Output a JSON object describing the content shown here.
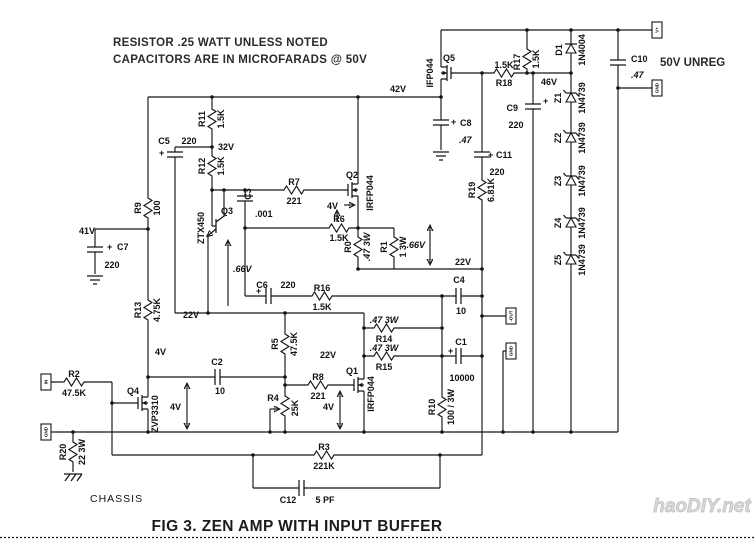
{
  "labels": {
    "note1": "RESISTOR  .25 WATT UNLESS NOTED",
    "note2": "CAPACITORS ARE IN MICROFARADS @ 50V",
    "caption": "FIG 3.  ZEN AMP WITH INPUT BUFFER",
    "watermark": "haoDIY.net",
    "supply": "50V UNREG",
    "chassis": "CHASSIS"
  },
  "terminals": {
    "input": "IN",
    "input_gnd": "GND",
    "output": "-OUT",
    "output_gnd": "GND",
    "supply_pos": "V+",
    "supply_gnd": "GND"
  },
  "symbols": {
    "plus": "+"
  },
  "voltages": {
    "v41": "41V",
    "v42": "42V",
    "v32": "32V",
    "v46": "46V",
    "v22_left": "22V",
    "v22_mid": "22V",
    "v22_out": "22V",
    "v4_q2": "4V",
    "v4_q4": "4V",
    "v4_q1": "4V",
    "v4_src": "4V",
    "vbe_q3": ".66V",
    "v_r1": ".66V"
  },
  "components": {
    "r0": {
      "ref": "R0",
      "value": ".47 3W"
    },
    "r1": {
      "ref": "R1",
      "value": "1 3W"
    },
    "r2": {
      "ref": "R2",
      "value": "47.5K"
    },
    "r3": {
      "ref": "R3",
      "value": "221K"
    },
    "r4": {
      "ref": "R4",
      "value": "25K"
    },
    "r5": {
      "ref": "R5",
      "value": "47.5K"
    },
    "r6": {
      "ref": "R6",
      "value": "1.5K"
    },
    "r7": {
      "ref": "R7",
      "value": "221"
    },
    "r8": {
      "ref": "R8",
      "value": "221"
    },
    "r9": {
      "ref": "R9",
      "value": "100"
    },
    "r10": {
      "ref": "R10",
      "value": "100 / 3W"
    },
    "r11": {
      "ref": "R11",
      "value": "1.5K"
    },
    "r12": {
      "ref": "R12",
      "value": "1.5K"
    },
    "r13": {
      "ref": "R13",
      "value": "4.75K"
    },
    "r14": {
      "ref": "R14",
      "value": ".47 3W"
    },
    "r15": {
      "ref": "R15",
      "value": ".47 3W"
    },
    "r16": {
      "ref": "R16",
      "value": "1.5K"
    },
    "r17": {
      "ref": "R17",
      "value": "1.5K"
    },
    "r18": {
      "ref": "R18",
      "value": "1.5K"
    },
    "r19": {
      "ref": "R19",
      "value": "6.81K"
    },
    "r20": {
      "ref": "R20",
      "value": "22 3W"
    },
    "c1": {
      "ref": "C1",
      "value": "10000"
    },
    "c2": {
      "ref": "C2",
      "value": "10"
    },
    "c3": {
      "ref": "C3",
      "value": ".001"
    },
    "c4": {
      "ref": "C4",
      "value": "10"
    },
    "c5": {
      "ref": "C5",
      "value": "220"
    },
    "c6": {
      "ref": "C6",
      "value": "220"
    },
    "c7": {
      "ref": "C7",
      "value": "220"
    },
    "c8": {
      "ref": "C8",
      "value": ".47"
    },
    "c9": {
      "ref": "C9",
      "value": "220"
    },
    "c10": {
      "ref": "C10",
      "value": ".47"
    },
    "c11": {
      "ref": "C11",
      "value": "220"
    },
    "c12": {
      "ref": "C12",
      "value": "5 PF"
    },
    "q1": {
      "ref": "Q1",
      "part": "IRFP044"
    },
    "q2": {
      "ref": "Q2",
      "part": "IRFP044"
    },
    "q3": {
      "ref": "Q3",
      "part": "ZTX450"
    },
    "q4": {
      "ref": "Q4",
      "part": "ZVP3310"
    },
    "q5": {
      "ref": "Q5",
      "part": "IFP044"
    },
    "d1": {
      "ref": "D1",
      "part": "1N4004"
    },
    "z1": {
      "ref": "Z1",
      "part": "1N4739"
    },
    "z2": {
      "ref": "Z2",
      "part": "1N4739"
    },
    "z3": {
      "ref": "Z3",
      "part": "1N4739"
    },
    "z4": {
      "ref": "Z4",
      "part": "1N4739"
    },
    "z5": {
      "ref": "Z5",
      "part": "1N4739"
    }
  }
}
